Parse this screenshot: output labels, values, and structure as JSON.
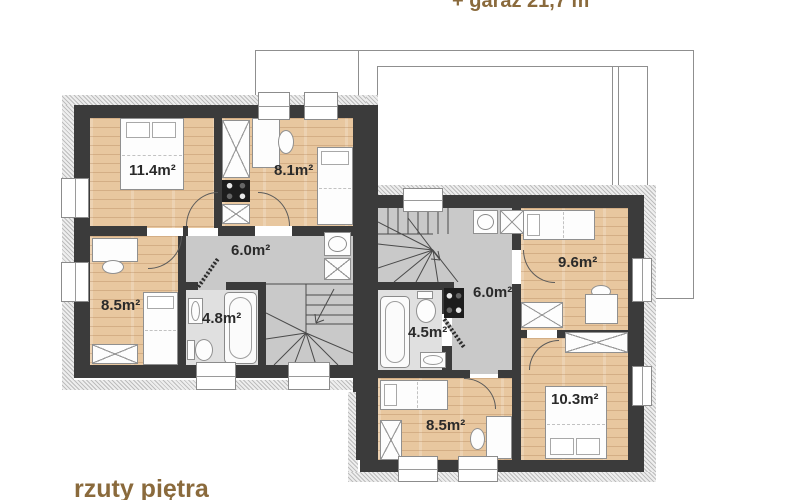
{
  "texts": {
    "garage_note": "+ garaż 21,7 m²",
    "caption": "rzuty piętra"
  },
  "colors": {
    "accent_text": "#8a6a3c",
    "wall": "#3b3b3b",
    "wood_floor": "#e8c79f",
    "hall_floor": "#c9c9c9",
    "bath_floor": "#e0e0e0"
  },
  "floor_plan": {
    "left_unit": {
      "rooms": [
        {
          "id": "bedroom-1",
          "area_label": "11.4m²"
        },
        {
          "id": "bedroom-2",
          "area_label": "8.1m²"
        },
        {
          "id": "bedroom-3",
          "area_label": "8.5m²"
        },
        {
          "id": "hall",
          "area_label": "6.0m²"
        },
        {
          "id": "bathroom",
          "area_label": "4.8m²"
        }
      ]
    },
    "right_unit": {
      "rooms": [
        {
          "id": "bedroom-1",
          "area_label": "9.6m²"
        },
        {
          "id": "hall",
          "area_label": "6.0m²"
        },
        {
          "id": "bathroom",
          "area_label": "4.5m²"
        },
        {
          "id": "bedroom-2",
          "area_label": "8.5m²"
        },
        {
          "id": "bedroom-3",
          "area_label": "10.3m²"
        }
      ]
    }
  }
}
